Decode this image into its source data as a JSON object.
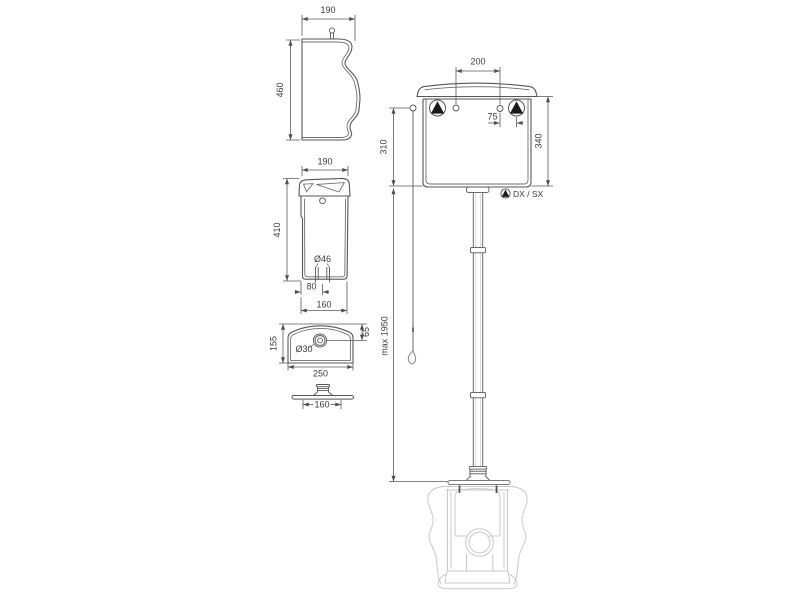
{
  "drawing": {
    "title": "High-level cistern technical drawing",
    "line_color": "#4f4f4f",
    "ghost_color": "#c9c9c9",
    "symbol_color": "#1a1a1a"
  },
  "views": {
    "side_profile": {
      "width": "190",
      "height": "460"
    },
    "side_section": {
      "top_width": "190",
      "height": "410",
      "outlet_diameter": "Ø46",
      "outlet_offset": "80",
      "base_width": "160"
    },
    "top_view": {
      "depth": "155",
      "hole_offset": "65",
      "hole_diameter": "Ø30",
      "width": "250"
    },
    "flange_profile": {
      "width": "160"
    },
    "assembly": {
      "hole_spacing": "200",
      "inlet_offset": "75",
      "lever_to_base": "310",
      "cistern_height": "340",
      "max_height": "max 1950",
      "inlet_legend": "DX / SX"
    }
  }
}
